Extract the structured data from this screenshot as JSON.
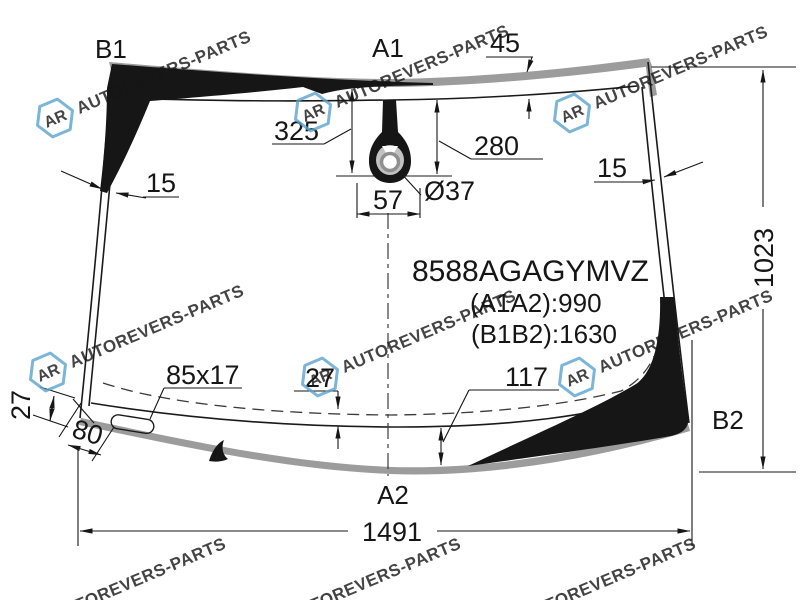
{
  "labels": {
    "b1": "B1",
    "a1": "A1",
    "b2": "B2",
    "a2": "A2"
  },
  "part_info": {
    "part_number": "8588AGAGYMVZ",
    "a1a2": "(A1A2):990",
    "b1b2": "(B1B2):1630"
  },
  "dims": {
    "top_molding": "45",
    "left_edge": "15",
    "right_edge": "15",
    "sensor_top_offset": "325",
    "sensor_bottom_offset": "280",
    "sensor_width": "57",
    "sensor_hole_dia": "Ø37",
    "glass_height": "1023",
    "pad_size": "85x17",
    "left_frit": "27",
    "center_frit": "27",
    "right_frit": "117",
    "pad_offset": "80",
    "bottom_width": "1491"
  },
  "watermark": {
    "text": "AUTOREVERS-PARTS",
    "logo": "AR",
    "color": "#6fa9d0"
  },
  "colors": {
    "frit_black": "#161616",
    "molding_gray": "#9c9c9c",
    "line": "#1a1a1a"
  }
}
